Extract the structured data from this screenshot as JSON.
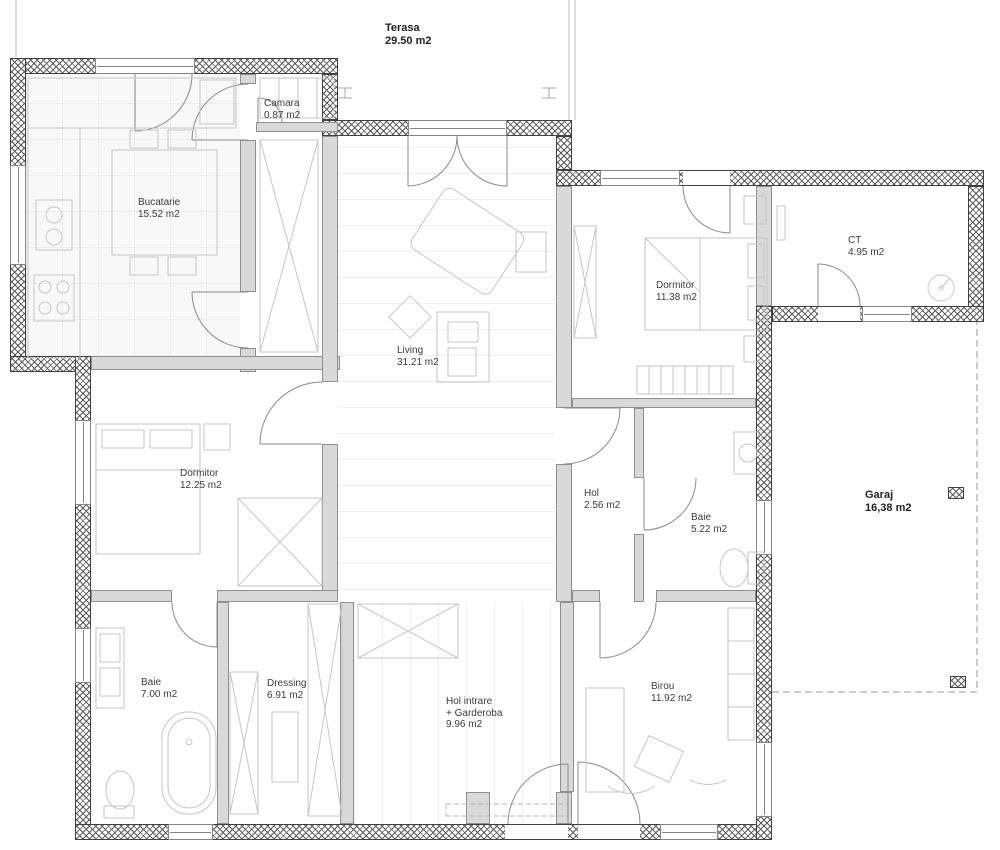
{
  "plan": {
    "title": "Floor plan",
    "rooms": [
      {
        "id": "terasa",
        "name": "Terasa",
        "area": "29.50 m2"
      },
      {
        "id": "camara",
        "name": "Camara",
        "area": "0.87 m2"
      },
      {
        "id": "bucatarie",
        "name": "Bucatarie",
        "area": "15.52 m2"
      },
      {
        "id": "living",
        "name": "Living",
        "area": "31.21 m2"
      },
      {
        "id": "dormitor-1",
        "name": "Dormitor",
        "area": "11.38 m2"
      },
      {
        "id": "ct",
        "name": "CT",
        "area": "4.95 m2"
      },
      {
        "id": "dormitor-2",
        "name": "Dormitor",
        "area": "12.25 m2"
      },
      {
        "id": "hol",
        "name": "Hol",
        "area": "2.56 m2"
      },
      {
        "id": "baie-1",
        "name": "Baie",
        "area": "5.22 m2"
      },
      {
        "id": "garaj",
        "name": "Garaj",
        "area": "16,38 m2"
      },
      {
        "id": "baie-2",
        "name": "Baie",
        "area": "7.00 m2"
      },
      {
        "id": "dressing",
        "name": "Dressing",
        "area": "6.91 m2"
      },
      {
        "id": "hol-intrare",
        "name": "Hol intrare",
        "name2": "+ Garderoba",
        "area": "9.96 m2"
      },
      {
        "id": "birou",
        "name": "Birou",
        "area": "11.92 m2"
      }
    ],
    "colors": {
      "wall_hatch": "#5a5a5a",
      "interior_wall": "#d9d9d9",
      "furniture_line": "#c6c6c6",
      "door_line": "#888888",
      "label_text": "#3c3c3c"
    }
  }
}
